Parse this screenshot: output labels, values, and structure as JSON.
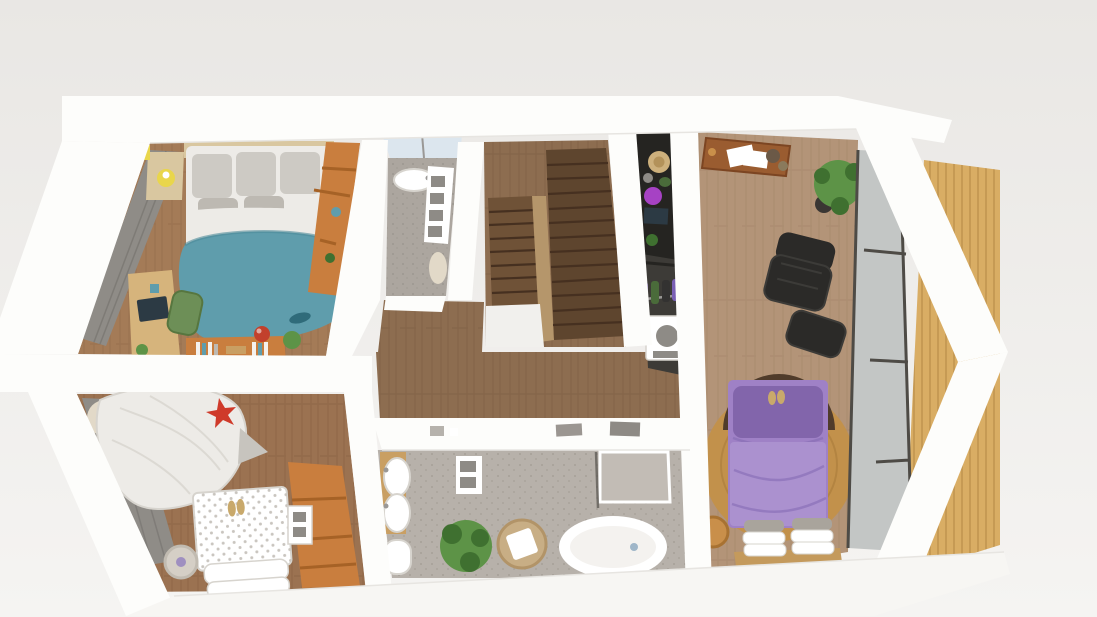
{
  "scene": {
    "description": "3D rendered top-down floor plan of an apartment upper floor with white cut-away walls",
    "view": "bird's-eye perspective render"
  },
  "palette": {
    "bgTop": "#e9e7e4",
    "bgBottom": "#f5f4f2",
    "wall": "#fdfdfb",
    "wallEdge": "#e7e5e1",
    "slab": "#f7f6f3",
    "deckWood": "#d9ad64",
    "deckLine": "#bb8f4b",
    "hallWood": "#8d6d50",
    "hallLine": "#765840",
    "bed1Wood": "#a47b57",
    "bed1Line": "#8b6444",
    "bed2Wood": "#9b7251",
    "bed2Line": "#815a3c",
    "masterWood": "#b39478",
    "masterLine": "#9e7f62",
    "bathFloor": "#b7b1aa",
    "bathSpeck": "#a19b93",
    "wcFloor": "#aca69f",
    "wcSpeck": "#97918a",
    "stairWood": "#6f5237",
    "stairStep": "#5e452e",
    "stairLine": "#463020",
    "stairRail": "#b5966b",
    "landing": "#f1f0ed",
    "closetDark": "#3d3b37",
    "closetBlack": "#252421",
    "wardrobe": "#8f8c87",
    "wardrobeLine": "#73706b",
    "rugTeal": "#5f9dac",
    "rugTealEdge": "#4d8a99",
    "fishTeal": "#2f6b7a",
    "rugJute": "#c2914b",
    "rugJuteLine": "#a87a3a",
    "bedPurple": "#9f81c6",
    "pillowPurple": "#8265ab",
    "duvetPurple": "#ab91cf",
    "purpleFold": "#8f74ba",
    "shelfOrange": "#c97e3e",
    "shelfOrangeDark": "#a66226",
    "deskPine": "#d6b47c",
    "deskBrown": "#9a5c30",
    "deskBrownEdge": "#7c4522",
    "chairGreen": "#6d8f57",
    "chairGreenEdge": "#57763f",
    "bedding": "#edebe7",
    "beddingShade": "#d7d4ce",
    "headboard": "#d9c7a0",
    "pillowGrey": "#cdcac4",
    "pillowGreyDark": "#bdb9b2",
    "knitGrey": "#a9a49c",
    "starRed": "#cf3a2a",
    "ballRed": "#c2402c",
    "plantGreen": "#5d9347",
    "plantDark": "#3f7030",
    "potDark": "#3a3633",
    "chairBlack": "#2b2a28",
    "chairBlackLight": "#3c3b38",
    "white": "#ffffff",
    "softWhite": "#f4f2ef",
    "greyBox": "#8e8b86",
    "glass": "#c3c6c5",
    "glassFrame": "#4e4b46",
    "wcGlass": "#dce6ee",
    "wicker": "#c8ae85",
    "wickerEdge": "#b29468",
    "lampYellow": "#e9d64b",
    "basketTan": "#c98f4a",
    "basketEdge": "#a87232",
    "metal": "#9a9896",
    "trayGrey": "#c2bcb5",
    "hatTan": "#cdb07c",
    "hatBand": "#b3925a",
    "purpleItem": "#a642c4",
    "clothes1": "#6b4fa0",
    "clothes2": "#4a6b3a",
    "clothes3": "#333231",
    "clothes4": "#7a5fb5",
    "clothes5": "#2e4d2a",
    "tvScreen": "#2c3a44",
    "woodLight": "#c99f63",
    "benchWood": "#c49a5c",
    "pouf": "#d5cfc6",
    "poufEdge": "#c1bbb1",
    "lavender": "#9f8fc0",
    "sand": "#c9a96b",
    "dotGrey": "#c9c5bf",
    "foldGrey": "#c7c4be",
    "canopyTop": "#e2d9c8"
  },
  "rooms": [
    {
      "id": "kids-bedroom-1",
      "label": "Kids bedroom 1",
      "furniture": [
        "single bed with grey bedding",
        "wooden headboard",
        "nightstand with yellow lamp",
        "grey wardrobe",
        "orange bookshelf",
        "teal rug",
        "study desk with laptop",
        "green desk chair",
        "orange sideboard with books",
        "red ball",
        "potted plant"
      ]
    },
    {
      "id": "wc",
      "label": "Small WC",
      "furniture": [
        "window",
        "oval washbasin",
        "white cabinet with grey drawers",
        "radiator"
      ]
    },
    {
      "id": "staircase",
      "label": "Staircase",
      "furniture": [
        "upper stair flight",
        "lower stair flight",
        "center handrail",
        "landing"
      ]
    },
    {
      "id": "walk-in-closet",
      "label": "Walk-in closet and laundry",
      "furniture": [
        "dark shelving with straw hat",
        "television",
        "clothes rail with hanging garments",
        "washing machine"
      ]
    },
    {
      "id": "hallway",
      "label": "Hallway",
      "furniture": []
    },
    {
      "id": "bathroom",
      "label": "Family bathroom",
      "furniture": [
        "double washbasin vanity",
        "toilet",
        "walk-in shower",
        "freestanding oval bathtub",
        "wicker chair with cushion",
        "potted plant",
        "wall cabinet"
      ]
    },
    {
      "id": "master-bedroom",
      "label": "Master bedroom studio",
      "furniture": [
        "wooden writing desk with papers",
        "potted plant",
        "black leather lounge chair with ottoman",
        "double bed with purple bedding",
        "round jute rug",
        "stacked white pillows on foot bench",
        "rattan basket",
        "floor-to-ceiling window"
      ]
    },
    {
      "id": "terrace",
      "label": "Wooden deck terrace",
      "furniture": [
        "timber decking"
      ]
    },
    {
      "id": "kids-bedroom-2",
      "label": "Kids bedroom 2",
      "furniture": [
        "canopy play tent",
        "red star cushion",
        "bed with polka-dot duvet",
        "round pouf",
        "orange corner shelf",
        "white cabinet",
        "grey wardrobe"
      ]
    }
  ]
}
